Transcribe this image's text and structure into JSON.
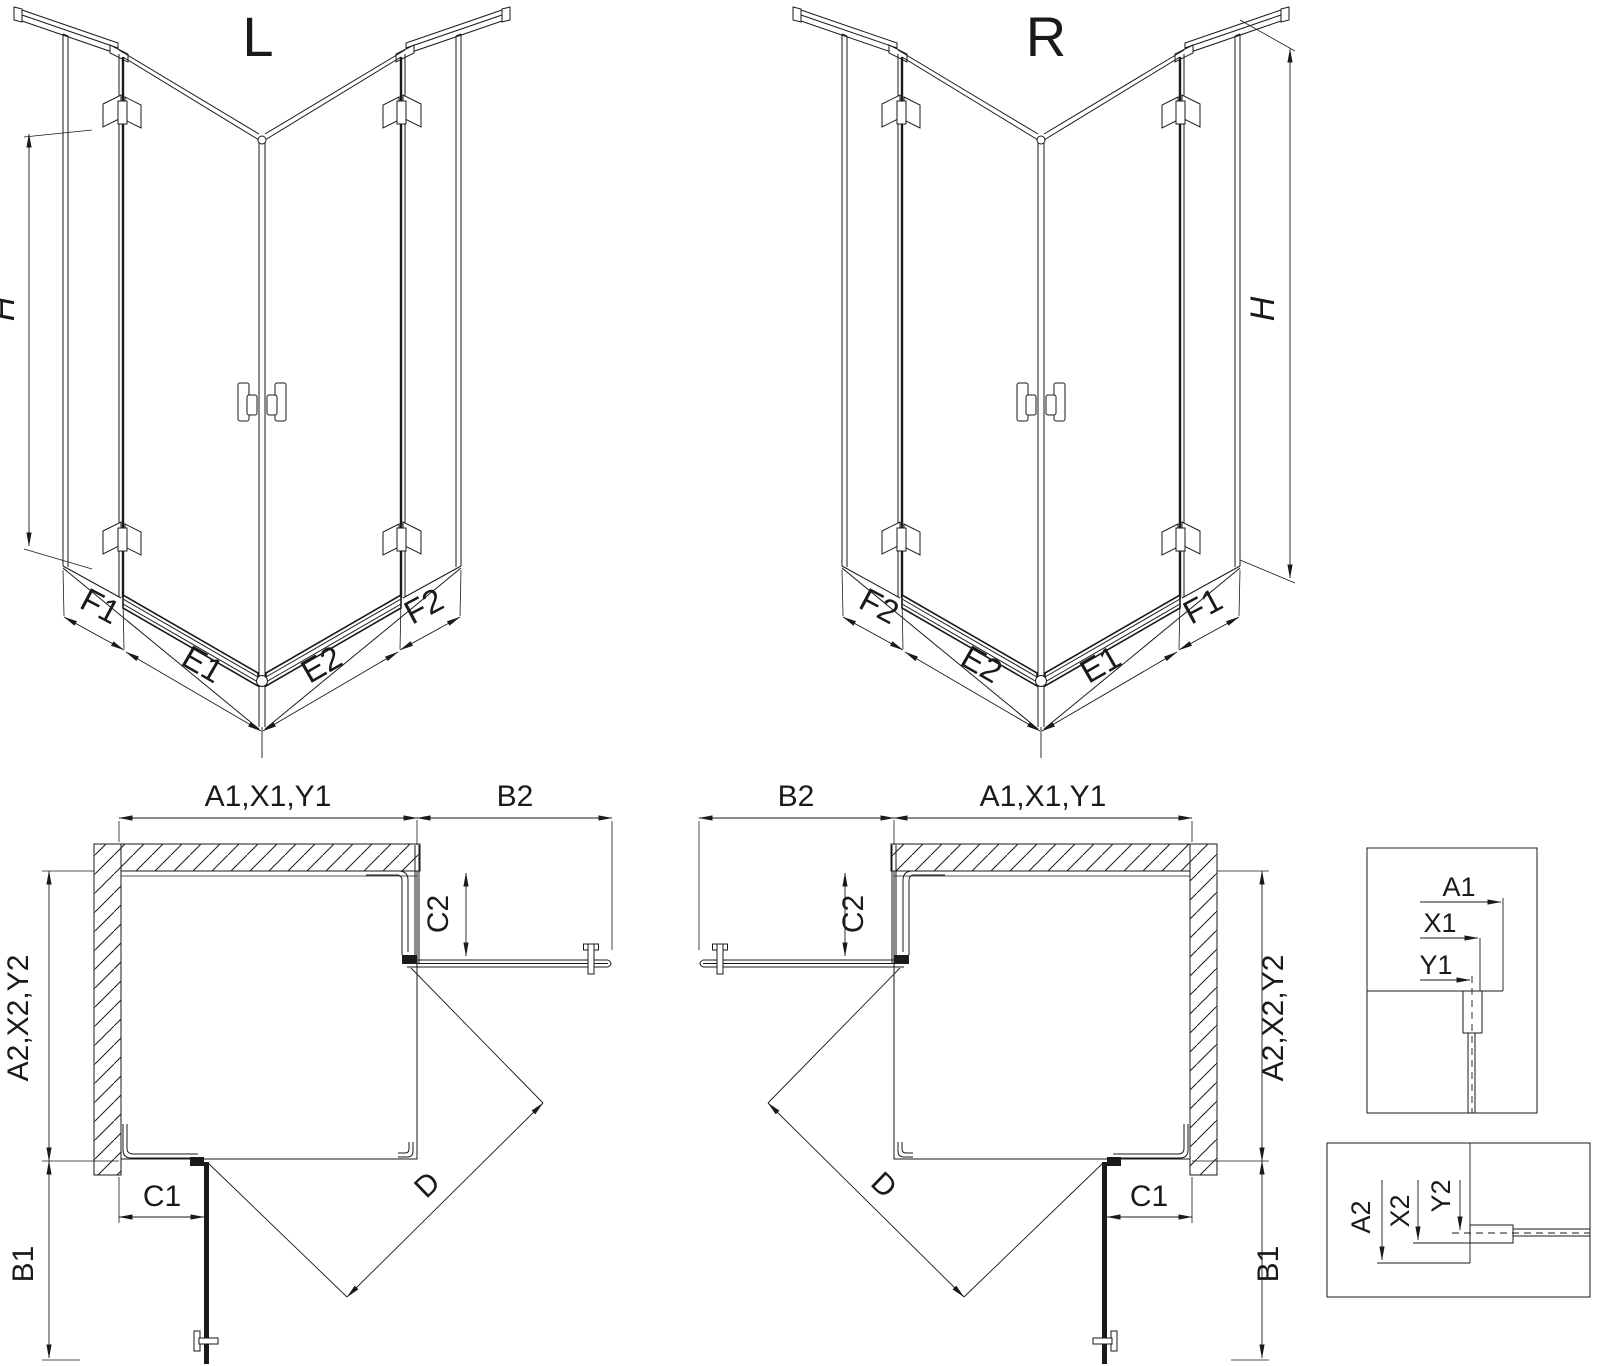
{
  "colors": {
    "line": "#1a1a1a",
    "background": "#ffffff"
  },
  "iso_left": {
    "label": "L",
    "height": "H",
    "widths": {
      "outer_left": "F1",
      "inner_left": "E1",
      "inner_right": "E2",
      "outer_right": "F2"
    }
  },
  "iso_right": {
    "label": "R",
    "height": "H",
    "widths": {
      "outer_left": "F2",
      "inner_left": "E2",
      "inner_right": "E1",
      "outer_right": "F1"
    }
  },
  "plan_left": {
    "top": "A1,X1,Y1",
    "door_top": "B2",
    "fixed_side": "C2",
    "side": "A2,X2,Y2",
    "fixed_bottom": "C1",
    "door_bottom": "B1",
    "diagonal": "D"
  },
  "plan_right": {
    "top": "A1,X1,Y1",
    "door_top": "B2",
    "fixed_side": "C2",
    "side": "A2,X2,Y2",
    "fixed_bottom": "C1",
    "door_bottom": "B1",
    "diagonal": "D"
  },
  "detail_top": {
    "dims": [
      "A1",
      "X1",
      "Y1"
    ]
  },
  "detail_bottom": {
    "dims": [
      "A2",
      "X2",
      "Y2"
    ]
  }
}
